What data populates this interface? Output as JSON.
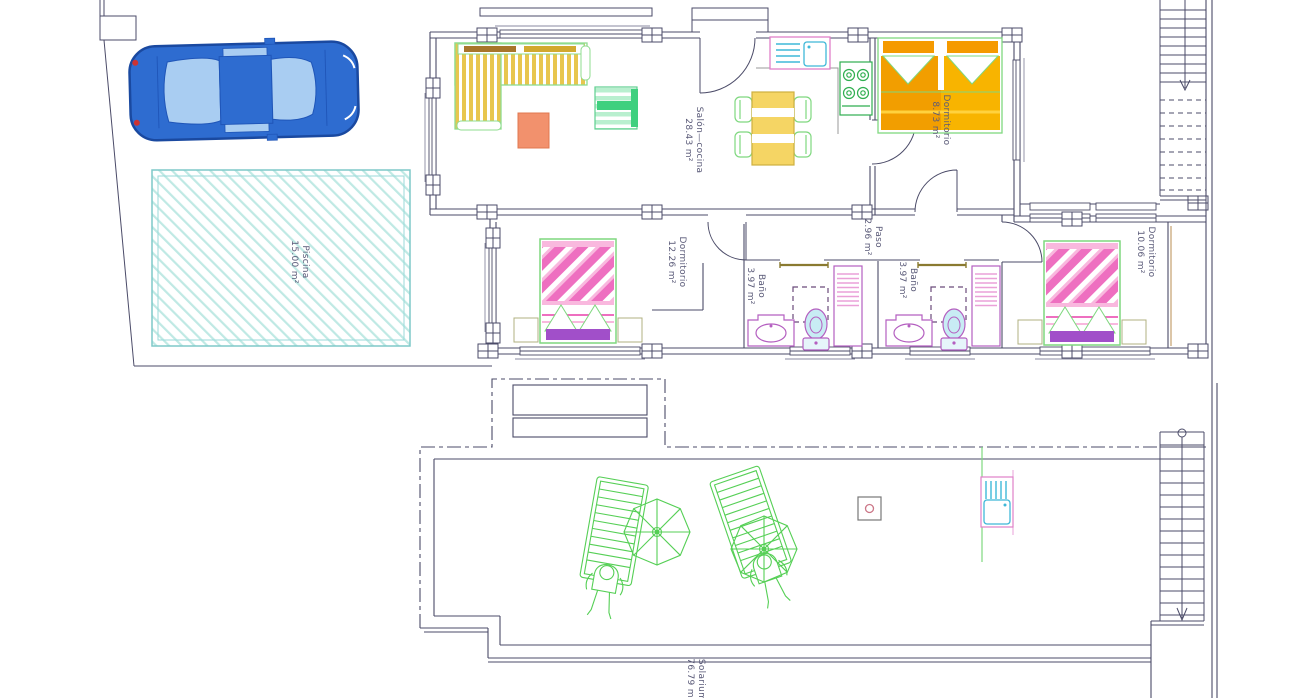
{
  "drawing": {
    "kind": "architectural floor plan",
    "levels": [
      "ground floor",
      "solarium / roof terrace"
    ]
  },
  "rooms": [
    {
      "id": "salon",
      "name": "Salón—cocina",
      "area": "28.43 m²"
    },
    {
      "id": "dorm1",
      "name": "Dormitorio",
      "area": "8.73 m²"
    },
    {
      "id": "piscina",
      "name": "Piscina",
      "area": "15.00 m²"
    },
    {
      "id": "dorm2",
      "name": "Dormitorio",
      "area": "12.26 m²"
    },
    {
      "id": "bano1",
      "name": "Baño",
      "area": "3.97 m²"
    },
    {
      "id": "paso",
      "name": "Paso",
      "area": "2.96 m²"
    },
    {
      "id": "bano2",
      "name": "Baño",
      "area": "3.97 m²"
    },
    {
      "id": "dorm3",
      "name": "Dormitorio",
      "area": "10.06 m²"
    },
    {
      "id": "solarium",
      "name": "Solarium",
      "area": "76.79 m²"
    }
  ],
  "colors": {
    "walls": "#4b4b68",
    "label_text": "#5a5a78",
    "pool_edge": "#7fc9c9",
    "car_body": "#2e6cd0",
    "furniture_green": "#55cf55",
    "bed_pink": "#ee6fc0",
    "bed_orange": "#f7a600",
    "bed_purple": "#a14fc9",
    "fixture_magenta": "#b45fc0",
    "sofa_yellow": "#e8c64e",
    "coffee_table_salmon": "#f2916d",
    "door_leaf": "#8a7a30",
    "sink_cyan": "#3fb8d8"
  }
}
